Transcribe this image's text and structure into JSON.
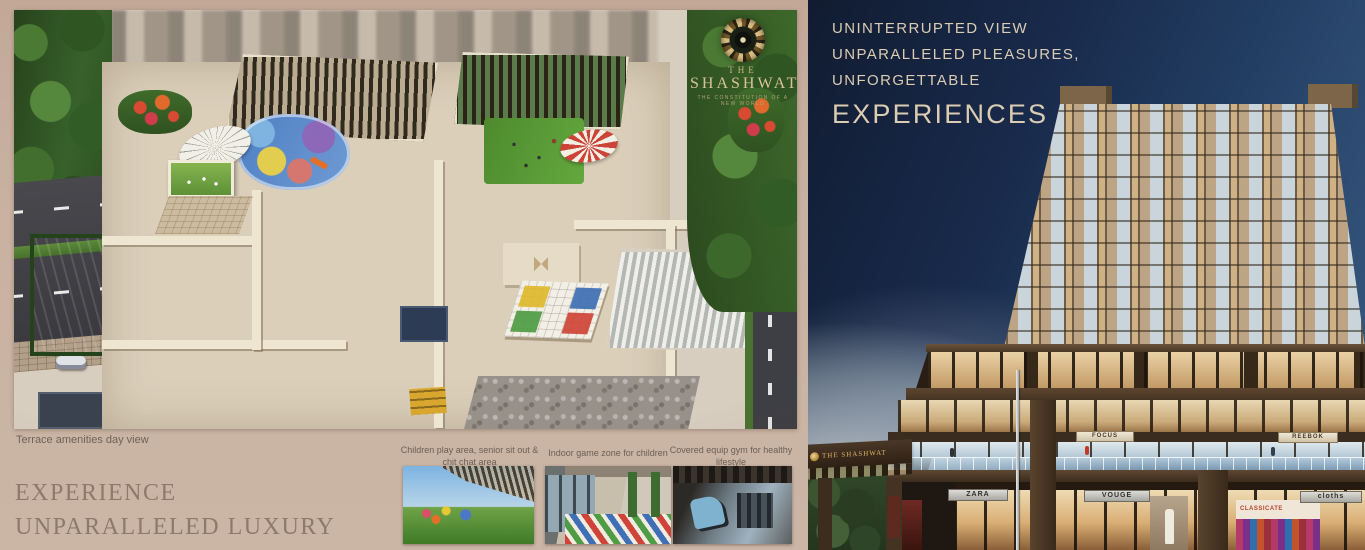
{
  "brand": {
    "the": "THE",
    "name": "SHASHWAT",
    "tagline": "THE CONSTITUTION OF A NEW WORLD",
    "logo_icon": "gold-swirl-emblem",
    "accent_gold": "#d8c498"
  },
  "left_page": {
    "render_caption": "Terrace amenities day view",
    "heading": "EXPERIENCE UNPARALLELED LUXURY",
    "thumbnails": [
      {
        "caption": "Children play area, senior sit out & chit chat area"
      },
      {
        "caption": "Indoor game zone for children"
      },
      {
        "caption": "Covered equip gym for healthy lifestyle"
      }
    ]
  },
  "right_page": {
    "headline_lines": [
      "UNINTERRUPTED VIEW",
      "UNPARALLELED PLEASURES,",
      "UNFORGETTABLE"
    ],
    "headline_emphasis": "EXPERIENCES",
    "gate_sign": "THE SHASHWAT",
    "signs": {
      "upper": [
        "FOCUS",
        "REEBOK"
      ],
      "ground": [
        "ZARA",
        "VOUGE",
        "cloths"
      ]
    },
    "poster_text": "CLASSICATE"
  },
  "colors": {
    "page_bg": "#c9b2a2",
    "left_heading_text": "#8e7a6b",
    "headline_text": "#dbccb2",
    "sky_dark": "#16243e",
    "sky_light": "#93a4ae",
    "facade_tan": "#b59b7e",
    "podium_brown": "#4a3726"
  }
}
